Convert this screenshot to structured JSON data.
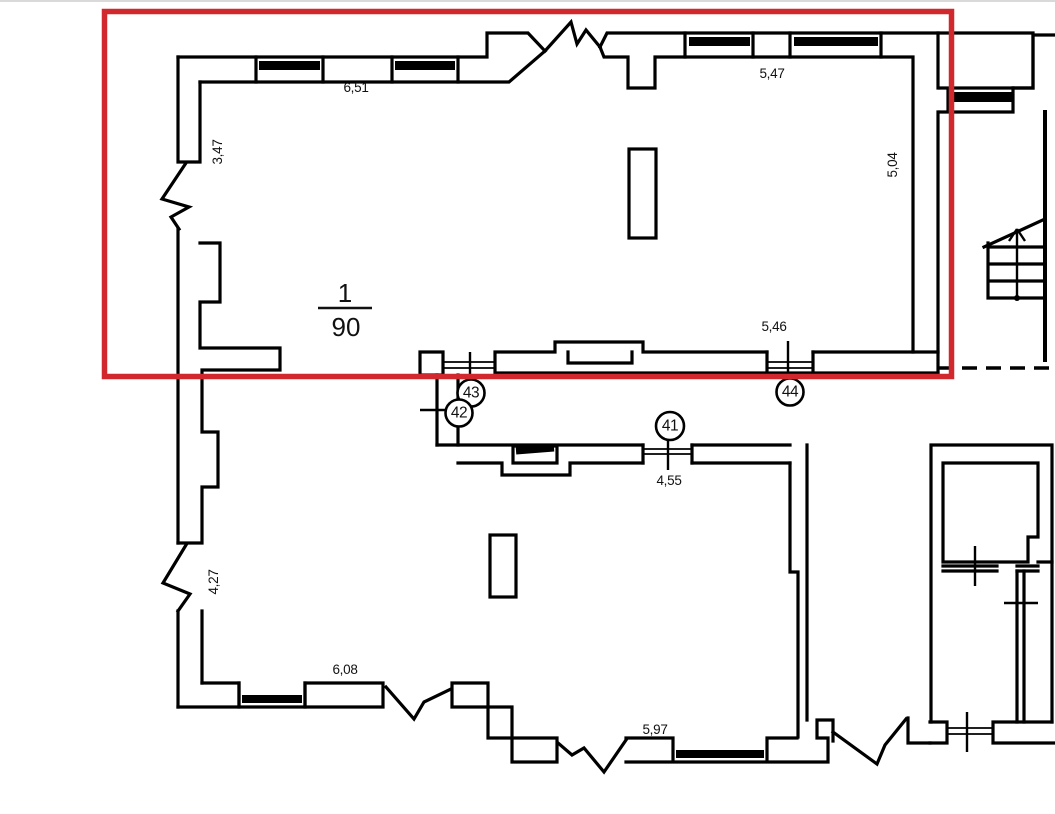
{
  "drawing": {
    "type": "architectural floor plan",
    "colors": {
      "line": "#000000",
      "highlight": "#d0282c",
      "background": "#ffffff"
    },
    "scale": {
      "numerator": "1",
      "denominator": "90"
    },
    "dimensions": {
      "top_left_wall": "6,51",
      "top_right_wall": "5,47",
      "left_upper_wall": "3,47",
      "right_upper_wall": "5,04",
      "mid_right_wall": "5,46",
      "mid_partition": "4,55",
      "left_lower_wall": "4,27",
      "bottom_left_wall": "6,08",
      "bottom_mid_wall": "5,97"
    },
    "markers": {
      "m41": "41",
      "m42": "42",
      "m43": "43",
      "m44": "44"
    }
  }
}
